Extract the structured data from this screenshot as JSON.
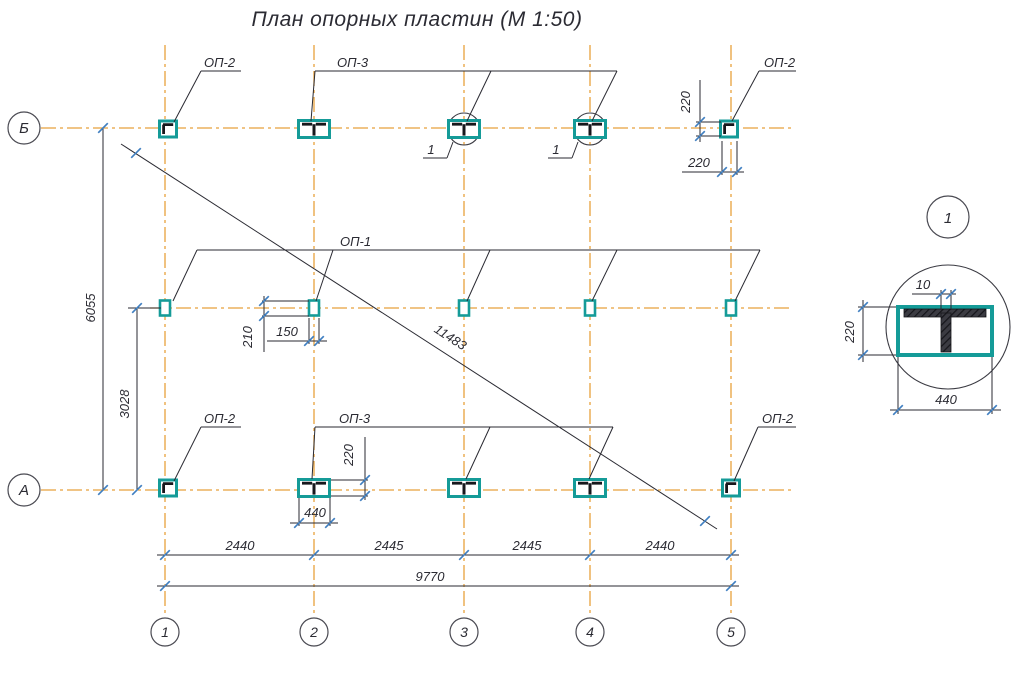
{
  "title": "План опорных пластин (М 1:50)",
  "labels": {
    "op1": "ОП-1",
    "op2": "ОП-2",
    "op3": "ОП-3",
    "detail_marker": "1"
  },
  "axis": {
    "row_top": "Б",
    "row_bottom": "А",
    "col_1": "1",
    "col_2": "2",
    "col_3": "3",
    "col_4": "4",
    "col_5": "5"
  },
  "dims": {
    "span_1": "2440",
    "span_2": "2445",
    "span_3": "2445",
    "span_4": "2440",
    "total_width": "9770",
    "height_total": "6055",
    "height_half": "3028",
    "diagonal": "11483",
    "d220": "220",
    "d440": "440",
    "d210": "210",
    "d150": "150",
    "d10": "10"
  },
  "detail": {
    "number": "1"
  },
  "colors": {
    "axis_line": "#E8A13C",
    "plate_teal": "#159B98",
    "tick_blue": "#3F7FC1",
    "drawing_black": "#2A2A32"
  }
}
